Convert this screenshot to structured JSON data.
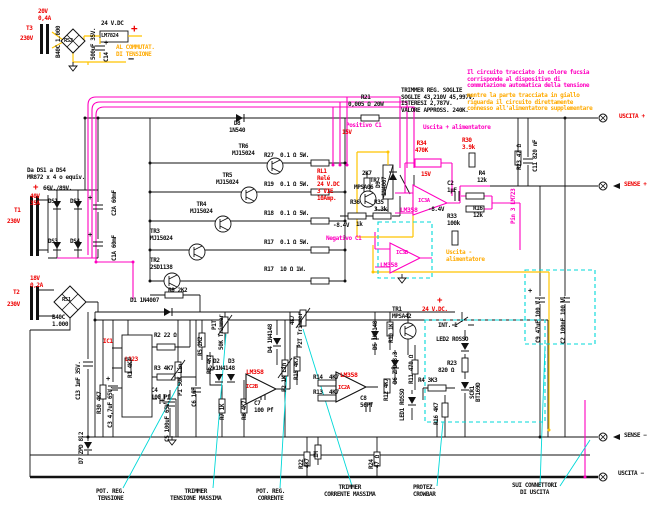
{
  "meta": {
    "title_hint": "Schema alimentatore stabilizzato con commutazione automatica della tensione"
  },
  "palette": {
    "black": "#111111",
    "red": "#ee0000",
    "magenta": "#ff00c0",
    "orange": "#ffaa00",
    "cyan": "#00d8d8"
  },
  "notes": {
    "trimmer_thresholds": "TRIMMER REG. SOGLIE\nSOGLIE 43,210V 45,997V.\nISTERESI 2,787V.\nVALORE APPROSS. 240K.",
    "fuchsia_circuit": "Il circuito tracciato in colore fucsia\ncorrisponde al dispositivo di\ncommutazione automatica della tensione",
    "yellow_circuit": "mentre la parte tracciata in giallo\nriguarda il circuito direttamente\nconnesso all'alimentatore supplementare"
  },
  "labels": [
    {
      "n": "t3-secondary-rating",
      "t": "20V\n0,4A",
      "x": 38,
      "y": 9,
      "c": "red"
    },
    {
      "n": "t3-label",
      "t": "T3",
      "x": 26,
      "y": 26,
      "c": "red"
    },
    {
      "n": "t3-primary",
      "t": "230V",
      "x": 20,
      "y": 36,
      "c": "red"
    },
    {
      "n": "rs2-part",
      "t": "B40C 1.000",
      "x": 56,
      "y": 58,
      "c": "black",
      "v": 1
    },
    {
      "n": "rs2-label",
      "t": "RS2",
      "x": 64,
      "y": 38,
      "c": "black",
      "s": 5.5
    },
    {
      "n": "c14-value",
      "t": "500uF 35V.",
      "x": 91,
      "y": 60,
      "c": "black",
      "v": 1
    },
    {
      "n": "c14-label",
      "t": "C14",
      "x": 104,
      "y": 62,
      "c": "black",
      "v": 1
    },
    {
      "n": "c14-plus",
      "t": "+",
      "x": 104,
      "y": 40,
      "c": "black",
      "s": 7
    },
    {
      "n": "aux-output-voltage",
      "t": "24 V.DC",
      "x": 101,
      "y": 21,
      "c": "black"
    },
    {
      "n": "aux-plus",
      "t": "+",
      "x": 131,
      "y": 23,
      "c": "red",
      "s": 11
    },
    {
      "n": "lm7824-label",
      "t": "LM7824",
      "x": 101,
      "y": 33,
      "c": "black",
      "s": 5.5
    },
    {
      "n": "commutator-note",
      "t": "AL COMMUTAT.\nDI TENSIONE",
      "x": 116,
      "y": 45,
      "c": "orange"
    },
    {
      "n": "aux-minus",
      "t": "−",
      "x": 128,
      "y": 54,
      "c": "black",
      "s": 10
    },
    {
      "n": "ds-diodes-note",
      "t": "Da DS1 a DS4\nMR872 x 4 o equiv.",
      "x": 27,
      "y": 168,
      "c": "black"
    },
    {
      "n": "plus-66v",
      "t": "+",
      "x": 33,
      "y": 183,
      "c": "red",
      "s": 9
    },
    {
      "n": "voltage-66-89",
      "t": "66V./89V.",
      "x": 43,
      "y": 186,
      "c": "black"
    },
    {
      "n": "ds1-label",
      "t": "DS1",
      "x": 48,
      "y": 199,
      "c": "black"
    },
    {
      "n": "ds2-label",
      "t": "DS2",
      "x": 70,
      "y": 199,
      "c": "black"
    },
    {
      "n": "ds3-label",
      "t": "DS3",
      "x": 48,
      "y": 239,
      "c": "black"
    },
    {
      "n": "ds4-label",
      "t": "DS4",
      "x": 70,
      "y": 239,
      "c": "black"
    },
    {
      "n": "t1-secondary-rating",
      "t": "40V\n35A",
      "x": 30,
      "y": 194,
      "c": "red"
    },
    {
      "n": "t1-label",
      "t": "T1",
      "x": 14,
      "y": 208,
      "c": "red"
    },
    {
      "n": "t1-primary",
      "t": "230V",
      "x": 7,
      "y": 219,
      "c": "red"
    },
    {
      "n": "c2a-label",
      "t": "C2A 60mF",
      "x": 112,
      "y": 216,
      "c": "black",
      "v": 1
    },
    {
      "n": "c1a-label",
      "t": "C1A 60mF",
      "x": 112,
      "y": 261,
      "c": "black",
      "v": 1
    },
    {
      "n": "c2a-plus",
      "t": "+",
      "x": 88,
      "y": 195,
      "c": "black",
      "s": 7
    },
    {
      "n": "c1a-plus",
      "t": "+",
      "x": 88,
      "y": 232,
      "c": "black",
      "s": 7
    },
    {
      "n": "t2-secondary-rating",
      "t": "18V\n0,2A",
      "x": 30,
      "y": 276,
      "c": "red"
    },
    {
      "n": "t2-label",
      "t": "T2",
      "x": 13,
      "y": 290,
      "c": "red"
    },
    {
      "n": "t2-primary",
      "t": "230V",
      "x": 7,
      "y": 302,
      "c": "red"
    },
    {
      "n": "rs1-label",
      "t": "RS1",
      "x": 62,
      "y": 297,
      "c": "black",
      "s": 5.5
    },
    {
      "n": "rs1-part",
      "t": "B40C\n1.000",
      "x": 52,
      "y": 315,
      "c": "black"
    },
    {
      "n": "c13-label",
      "t": "C13 1mF 35V.",
      "x": 76,
      "y": 400,
      "c": "black",
      "v": 1
    },
    {
      "n": "d7-label",
      "t": "D7 ZPD 8.2",
      "x": 79,
      "y": 464,
      "c": "black",
      "v": 1
    },
    {
      "n": "tr6-label",
      "t": "TR6\nMJ15024",
      "x": 232,
      "y": 144,
      "c": "black",
      "ctr": 1
    },
    {
      "n": "r27-label",
      "t": "R27  0.1 Ω 5W.",
      "x": 264,
      "y": 153,
      "c": "black"
    },
    {
      "n": "tr5-label",
      "t": "TR5\nMJ15024",
      "x": 216,
      "y": 173,
      "c": "black",
      "ctr": 1
    },
    {
      "n": "r19-label",
      "t": "R19  0.1 Ω 5W.",
      "x": 264,
      "y": 182,
      "c": "black"
    },
    {
      "n": "tr4-label",
      "t": "TR4\nMJ15024",
      "x": 190,
      "y": 202,
      "c": "black",
      "ctr": 1
    },
    {
      "n": "r18-label",
      "t": "R18  0.1 Ω 5W.",
      "x": 264,
      "y": 211,
      "c": "black"
    },
    {
      "n": "tr3-label",
      "t": "TR3\nMJ15024",
      "x": 150,
      "y": 229,
      "c": "black"
    },
    {
      "n": "r17-label",
      "t": "R17  0.1 Ω 5W.",
      "x": 264,
      "y": 240,
      "c": "black"
    },
    {
      "n": "tr2-label",
      "t": "TR2\n2SD1138",
      "x": 150,
      "y": 258,
      "c": "black"
    },
    {
      "n": "r17b-label",
      "t": "R17  10 Ω 1W.",
      "x": 264,
      "y": 267,
      "c": "black"
    },
    {
      "n": "r9-label",
      "t": "R9 2K2",
      "x": 168,
      "y": 288,
      "c": "black"
    },
    {
      "n": "d8-label",
      "t": "D8\n1N540",
      "x": 229,
      "y": 121,
      "c": "black",
      "ctr": 1
    },
    {
      "n": "r21-label",
      "t": "R21\n0,005 Ω 20W",
      "x": 348,
      "y": 95,
      "c": "black",
      "ctr": 1
    },
    {
      "n": "positivo-c1-label",
      "t": "Positivo C1",
      "x": 346,
      "y": 123,
      "c": "magenta"
    },
    {
      "n": "positivo-15v",
      "t": "15V",
      "x": 342,
      "y": 130,
      "c": "red"
    },
    {
      "n": "rl1-label",
      "t": "RL1\nRelé\n24 V.DC\n3 VIE\n10Amp.",
      "x": 317,
      "y": 169,
      "c": "red"
    },
    {
      "n": "d9-label",
      "t": "D9",
      "x": 376,
      "y": 188,
      "c": "black",
      "v": 1
    },
    {
      "n": "d9-part",
      "t": "1N4007",
      "x": 382,
      "y": 196,
      "c": "black",
      "v": 1
    },
    {
      "n": "tr7-base-resistor",
      "t": "2K7",
      "x": 362,
      "y": 171,
      "c": "black"
    },
    {
      "n": "tr7-label",
      "t": "TR7",
      "x": 370,
      "y": 178,
      "c": "black"
    },
    {
      "n": "tr7-part",
      "t": "MPSA06",
      "x": 354,
      "y": 185,
      "c": "black"
    },
    {
      "n": "r36-label",
      "t": "R36",
      "x": 350,
      "y": 200,
      "c": "black"
    },
    {
      "n": "r36-value",
      "t": "1k",
      "x": 356,
      "y": 222,
      "c": "black"
    },
    {
      "n": "r35-label",
      "t": "R35\n3.3k",
      "x": 374,
      "y": 200,
      "c": "black"
    },
    {
      "n": "r34-label",
      "t": "R34\n470K",
      "x": 415,
      "y": 141,
      "c": "red",
      "ctr": 1
    },
    {
      "n": "ic3a-supply",
      "t": "15V",
      "x": 421,
      "y": 172,
      "c": "red"
    },
    {
      "n": "ic3a-label",
      "t": "IC3A",
      "x": 418,
      "y": 198,
      "c": "magenta",
      "s": 5.5
    },
    {
      "n": "ic3a-part",
      "t": "LM358",
      "x": 400,
      "y": 207,
      "c": "magenta",
      "s": 6.5
    },
    {
      "n": "ic3a-neg-supply",
      "t": "-8.4V",
      "x": 428,
      "y": 207,
      "c": "black"
    },
    {
      "n": "r33-label",
      "t": "R33\n100k",
      "x": 447,
      "y": 214,
      "c": "black"
    },
    {
      "n": "uscita-plus-alim",
      "t": "Uscita + alimentatore",
      "x": 423,
      "y": 125,
      "c": "magenta"
    },
    {
      "n": "r30-label",
      "t": "R30\n3.9k",
      "x": 462,
      "y": 138,
      "c": "red"
    },
    {
      "n": "r4-label",
      "t": "R4\n12k",
      "x": 477,
      "y": 171,
      "c": "black",
      "ctr": 1
    },
    {
      "n": "c2-mid-label",
      "t": "C2\n1µF",
      "x": 447,
      "y": 181,
      "c": "black"
    },
    {
      "n": "r16-label",
      "t": "R16\n12k",
      "x": 473,
      "y": 206,
      "c": "black",
      "ctr": 1
    },
    {
      "n": "pin3-lm723",
      "t": "Pin 3 LM723",
      "x": 511,
      "y": 224,
      "c": "magenta",
      "v": 1
    },
    {
      "n": "r23-label",
      "t": "R23 47 Ω",
      "x": 517,
      "y": 170,
      "c": "black",
      "v": 1
    },
    {
      "n": "c11-label",
      "t": "C11 820 nF",
      "x": 533,
      "y": 172,
      "c": "black",
      "v": 1
    },
    {
      "n": "negativo-c1-label",
      "t": "Negativo C1",
      "x": 326,
      "y": 236,
      "c": "magenta"
    },
    {
      "n": "ic3b-neg-supply",
      "t": "-8.4V",
      "x": 333,
      "y": 223,
      "c": "black"
    },
    {
      "n": "ic3b-label",
      "t": "IC3B",
      "x": 396,
      "y": 250,
      "c": "magenta",
      "s": 5.5
    },
    {
      "n": "ic3b-part",
      "t": "LM358",
      "x": 380,
      "y": 262,
      "c": "magenta",
      "s": 6.5
    },
    {
      "n": "uscita-minus-alim",
      "t": "Uscita -\nalimentatore",
      "x": 446,
      "y": 250,
      "c": "orange"
    },
    {
      "n": "plus-24v",
      "t": "+",
      "x": 437,
      "y": 296,
      "c": "red",
      "s": 9
    },
    {
      "n": "v24dc-label",
      "t": "24 V.DC.",
      "x": 422,
      "y": 307,
      "c": "red"
    },
    {
      "n": "d1-label",
      "t": "D1 1N4007",
      "x": 130,
      "y": 298,
      "c": "black"
    },
    {
      "n": "ic1-label",
      "t": "IC1",
      "x": 103,
      "y": 339,
      "c": "red"
    },
    {
      "n": "ic1-part",
      "t": "L123",
      "x": 125,
      "y": 357,
      "c": "red"
    },
    {
      "n": "r2-label",
      "t": "R2 22 Ω",
      "x": 154,
      "y": 333,
      "c": "black"
    },
    {
      "n": "r3-label",
      "t": "R3 4K7",
      "x": 154,
      "y": 366,
      "c": "black"
    },
    {
      "n": "c4-label",
      "t": "C4\n100 Pf",
      "x": 151,
      "y": 388,
      "c": "black"
    },
    {
      "n": "r1-label",
      "t": "R1 4K7",
      "x": 128,
      "y": 378,
      "c": "black",
      "v": 1
    },
    {
      "n": "c3-label",
      "t": "C3 4,7uF 65V.",
      "x": 108,
      "y": 428,
      "c": "black",
      "v": 1
    },
    {
      "n": "c3-plus",
      "t": "+",
      "x": 106,
      "y": 376,
      "c": "black",
      "s": 7
    },
    {
      "n": "r30b-label",
      "t": "R30 4K7",
      "x": 97,
      "y": 414,
      "c": "black",
      "v": 1
    },
    {
      "n": "p1-label",
      "t": "P1 50K Lin",
      "x": 178,
      "y": 396,
      "c": "black",
      "v": 1
    },
    {
      "n": "c5-label",
      "t": "C5 100uF 65V.",
      "x": 165,
      "y": 442,
      "c": "black",
      "v": 1
    },
    {
      "n": "c5-plus",
      "t": "+",
      "x": 160,
      "y": 398,
      "c": "black",
      "s": 7
    },
    {
      "n": "c6-label",
      "t": "C6 1nF",
      "x": 192,
      "y": 407,
      "c": "black",
      "v": 1
    },
    {
      "n": "r5-label",
      "t": "R5 2K2",
      "x": 198,
      "y": 356,
      "c": "black",
      "v": 1
    },
    {
      "n": "r6-label",
      "t": "R6 4K7",
      "x": 207,
      "y": 374,
      "c": "black",
      "v": 1
    },
    {
      "n": "p1t-label",
      "t": "P1T",
      "x": 212,
      "y": 330,
      "c": "black",
      "v": 1
    },
    {
      "n": "p1t-value",
      "t": "50K Trimmer",
      "x": 219,
      "y": 350,
      "c": "black",
      "v": 1
    },
    {
      "n": "d2-label",
      "t": "D2",
      "x": 213,
      "y": 359,
      "c": "black"
    },
    {
      "n": "d3-label",
      "t": "D3",
      "x": 228,
      "y": 359,
      "c": "black"
    },
    {
      "n": "d2d3-part",
      "t": "2x1N4148",
      "x": 209,
      "y": 366,
      "c": "black"
    },
    {
      "n": "r7-label",
      "t": "R7 1K",
      "x": 220,
      "y": 420,
      "c": "black",
      "v": 1
    },
    {
      "n": "r8-label",
      "t": "R8 4K7",
      "x": 242,
      "y": 420,
      "c": "black",
      "v": 1
    },
    {
      "n": "ic2b-part",
      "t": "LM358",
      "x": 246,
      "y": 369,
      "c": "red",
      "s": 6.5
    },
    {
      "n": "ic2b-label",
      "t": "IC2B",
      "x": 246,
      "y": 384,
      "c": "red",
      "s": 5.5
    },
    {
      "n": "c7-label",
      "t": "C7\n100 Pf",
      "x": 254,
      "y": 401,
      "c": "black"
    },
    {
      "n": "d4-label",
      "t": "D4 1N4148",
      "x": 268,
      "y": 353,
      "c": "black",
      "v": 1
    },
    {
      "n": "p2-label",
      "t": "P2 1K Lin",
      "x": 282,
      "y": 392,
      "c": "black",
      "v": 1
    },
    {
      "n": "r15-label",
      "t": "R15 4K7",
      "x": 294,
      "y": 380,
      "c": "black",
      "v": 1
    },
    {
      "n": "p2t-value",
      "t": "4K7",
      "x": 290,
      "y": 325,
      "c": "black",
      "v": 1
    },
    {
      "n": "p2t-label",
      "t": "P2T Trimmer",
      "x": 298,
      "y": 348,
      "c": "black",
      "v": 1
    },
    {
      "n": "r14-label",
      "t": "R14  4K7",
      "x": 313,
      "y": 375,
      "c": "black"
    },
    {
      "n": "r13-label",
      "t": "R13  4K7",
      "x": 313,
      "y": 390,
      "c": "black"
    },
    {
      "n": "ic2a-part",
      "t": "LM358",
      "x": 340,
      "y": 372,
      "c": "red",
      "s": 6.5
    },
    {
      "n": "ic2a-label",
      "t": "IC2A",
      "x": 338,
      "y": 385,
      "c": "red",
      "s": 5.5
    },
    {
      "n": "c8-label",
      "t": "C8\n56Pf",
      "x": 360,
      "y": 396,
      "c": "black"
    },
    {
      "n": "d5-label",
      "t": "D5 1N4148",
      "x": 373,
      "y": 350,
      "c": "black",
      "v": 1
    },
    {
      "n": "r10-label",
      "t": "R10 1K",
      "x": 389,
      "y": 343,
      "c": "black",
      "v": 1
    },
    {
      "n": "tr1-label",
      "t": "TR1\nMPSA42",
      "x": 392,
      "y": 307,
      "c": "black"
    },
    {
      "n": "d6-label",
      "t": "D6 ZPD 3.3",
      "x": 393,
      "y": 384,
      "c": "black",
      "v": 1
    },
    {
      "n": "r12-label",
      "t": "R12 4K7",
      "x": 384,
      "y": 401,
      "c": "black",
      "v": 1
    },
    {
      "n": "r11-label",
      "t": "R11 470 Ω",
      "x": 409,
      "y": 384,
      "c": "black",
      "v": 1
    },
    {
      "n": "led1-label",
      "t": "LED1 ROSSO",
      "x": 400,
      "y": 421,
      "c": "black",
      "v": 1
    },
    {
      "n": "int1-label",
      "t": "INT. 1",
      "x": 438,
      "y": 323,
      "c": "black"
    },
    {
      "n": "led2-label",
      "t": "LED2 ROSSO",
      "x": 436,
      "y": 337,
      "c": "black"
    },
    {
      "n": "r23b-label",
      "t": "R23",
      "x": 447,
      "y": 361,
      "c": "black"
    },
    {
      "n": "r23b-value",
      "t": "820 Ω",
      "x": 438,
      "y": 368,
      "c": "black"
    },
    {
      "n": "scr1-label",
      "t": "SCR1",
      "x": 470,
      "y": 399,
      "c": "black",
      "v": 1
    },
    {
      "n": "scr1-part",
      "t": "BT169D",
      "x": 476,
      "y": 402,
      "c": "black",
      "v": 1
    },
    {
      "n": "r4b-label",
      "t": "R4 3K3",
      "x": 418,
      "y": 378,
      "c": "black"
    },
    {
      "n": "r16b-label",
      "t": "R16 4K7",
      "x": 434,
      "y": 425,
      "c": "black",
      "v": 1
    },
    {
      "n": "r22-label",
      "t": "R22",
      "x": 299,
      "y": 469,
      "c": "black",
      "v": 1
    },
    {
      "n": "r22-value",
      "t": "4K7",
      "x": 305,
      "y": 468,
      "c": "black",
      "v": 1
    },
    {
      "n": "r-1m-label",
      "t": "1M",
      "x": 314,
      "y": 458,
      "c": "black",
      "v": 1
    },
    {
      "n": "r24-label",
      "t": "R24",
      "x": 369,
      "y": 469,
      "c": "black",
      "v": 1
    },
    {
      "n": "r24-value",
      "t": "47 Ω",
      "x": 375,
      "y": 468,
      "c": "black",
      "v": 1
    },
    {
      "n": "trimmer-threshold-note",
      "t": "TRIMMER REG. SOGLIE\nSOGLIE 43,210V 45,997V.\nISTERESI 2,787V.\nVALORE APPROSS. 240K.",
      "x": 401,
      "y": 88,
      "c": "black"
    },
    {
      "n": "fuchsia-circuit-note",
      "t": "Il circuito tracciato in colore fucsia\ncorrisponde al dispositivo di\ncommutazione automatica della tensione",
      "x": 467,
      "y": 70,
      "c": "magenta"
    },
    {
      "n": "yellow-circuit-note",
      "t": "mentre la parte tracciata in giallo\nriguarda il circuito direttamente\nconnesso all'alimentatore supplementare",
      "x": 467,
      "y": 93,
      "c": "orange"
    },
    {
      "n": "uscita-plus-label",
      "t": "USCITA +",
      "x": 619,
      "y": 114,
      "c": "red"
    },
    {
      "n": "sense-plus-label",
      "t": "SENSE +",
      "x": 624,
      "y": 182,
      "c": "red"
    },
    {
      "n": "sense-minus-label",
      "t": "SENSE −",
      "x": 624,
      "y": 433,
      "c": "black"
    },
    {
      "n": "uscita-minus-label",
      "t": "USCITA −",
      "x": 618,
      "y": 471,
      "c": "black"
    },
    {
      "n": "pot-reg-tensione-callout",
      "t": "POT. REG.\nTENSIONE",
      "x": 96,
      "y": 489,
      "c": "black",
      "ctr": 1
    },
    {
      "n": "trimmer-tensione-callout",
      "t": "TRIMMER\nTENSIONE MASSIMA",
      "x": 170,
      "y": 489,
      "c": "black",
      "ctr": 1
    },
    {
      "n": "pot-reg-corrente-callout",
      "t": "POT. REG.\nCORRENTE",
      "x": 256,
      "y": 489,
      "c": "black",
      "ctr": 1
    },
    {
      "n": "trimmer-corrente-callout",
      "t": "TRIMMER\nCORRENTE MASSIMA",
      "x": 324,
      "y": 485,
      "c": "black",
      "ctr": 1
    },
    {
      "n": "protez-crowbar-callout",
      "t": "PROTEZ.\nCROWBAR",
      "x": 413,
      "y": 485,
      "c": "black",
      "ctr": 1
    },
    {
      "n": "connettori-callout",
      "t": "SUI CONNETTORI\nDI USCITA",
      "x": 512,
      "y": 483,
      "c": "black",
      "ctr": 1
    },
    {
      "n": "c9-label",
      "t": "C9 47uF 100 V.",
      "x": 536,
      "y": 343,
      "c": "black",
      "v": 1
    },
    {
      "n": "c9-plus",
      "t": "+",
      "x": 528,
      "y": 288,
      "c": "black",
      "s": 7
    },
    {
      "n": "c2-out-label",
      "t": "C2 100nF 100 V.",
      "x": 561,
      "y": 344,
      "c": "black",
      "v": 1
    }
  ]
}
